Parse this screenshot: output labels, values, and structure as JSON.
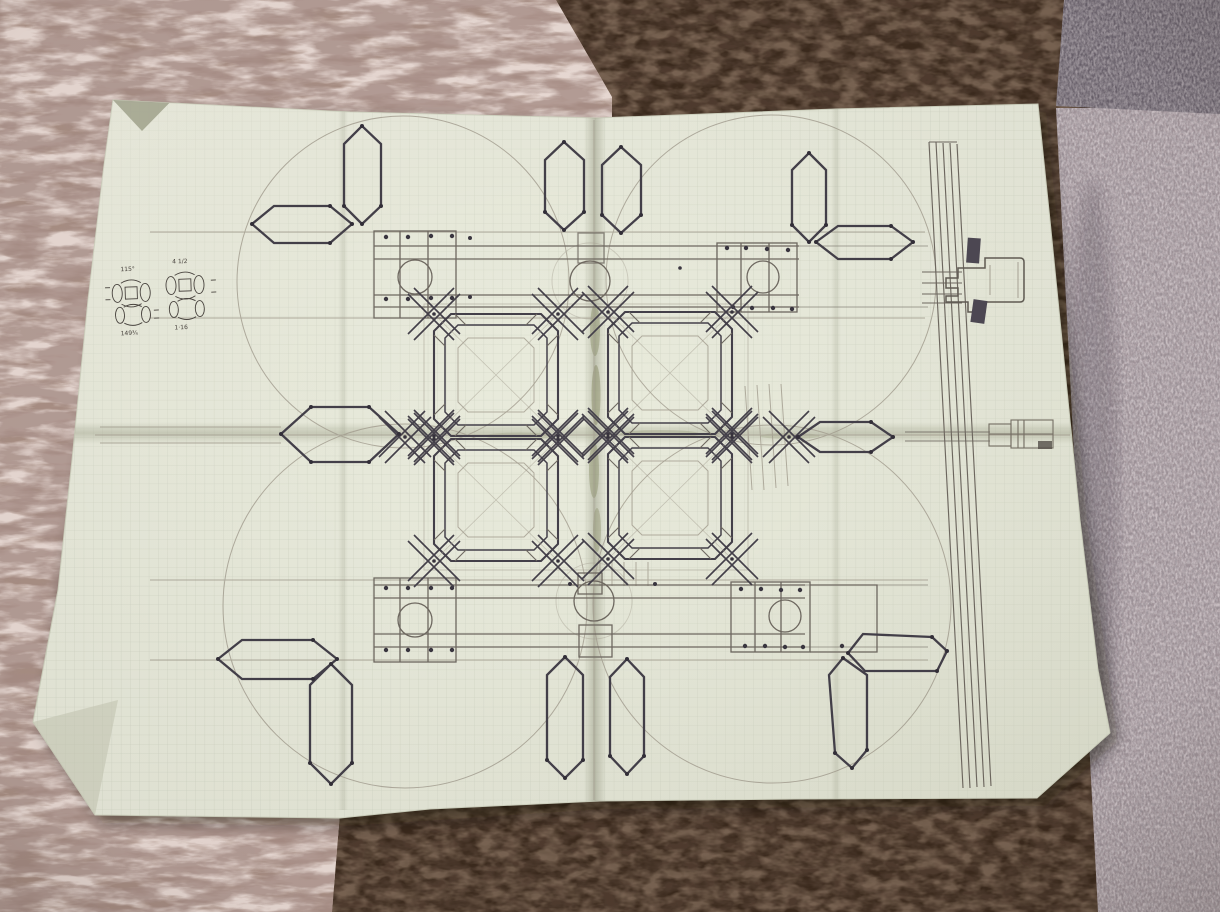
{
  "scene": {
    "type": "photograph",
    "subject": "hand-drawn pencil blueprint of an interlocking frame mechanism on green graph paper, lying on carpet",
    "paper": "folded graph paper sheet",
    "background": "shag carpet, brown carpet, gray and mauve carpet tiles"
  },
  "notes": {
    "top_left": "115°",
    "top_right": "4 1/2",
    "bottom_left": "149¾",
    "bottom_right": "1·16"
  },
  "colors": {
    "paper": "#e9ebdc",
    "grid": "#aeb5a2",
    "pencil_dark": "#44404a",
    "pencil_medium": "#6f6961",
    "pencil_faint": "#a49e90",
    "carpet_shag": "#ab9186",
    "carpet_brown": "#3b2a1d",
    "carpet_tile_gray": "#6a626d",
    "carpet_tile_mauve": "#a79aa0"
  }
}
